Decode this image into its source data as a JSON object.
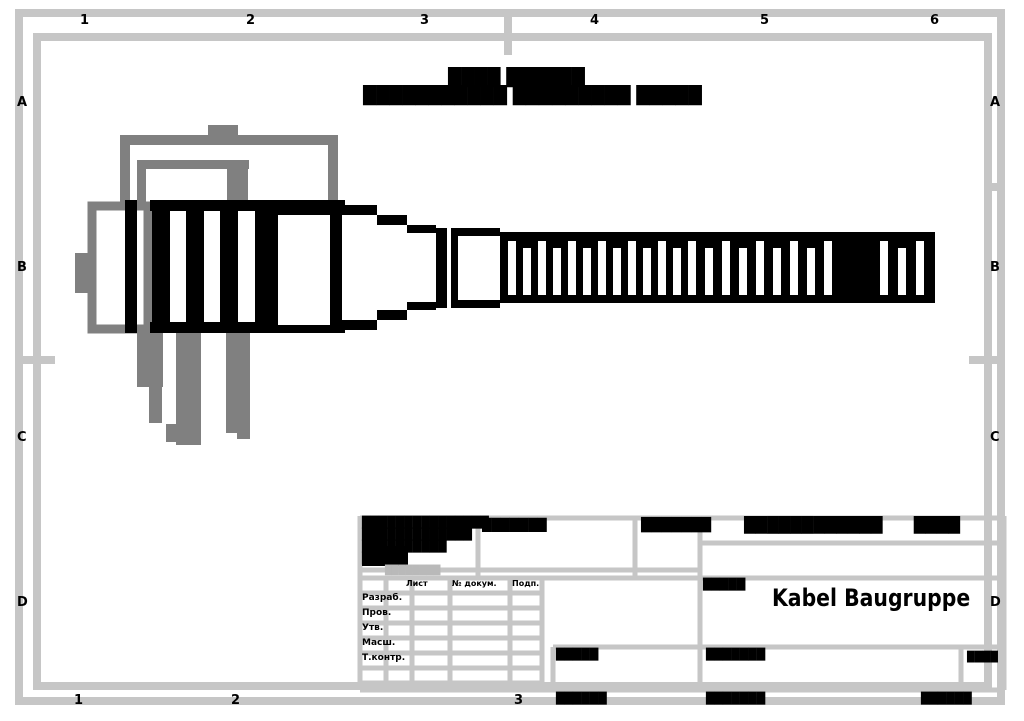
{
  "colors": {
    "line_black": "#000000",
    "layer_gray": "#808080",
    "frame_silver": "#c6c6c6",
    "paper_white": "#ffffff"
  },
  "frame": {
    "zones_top": [
      "1",
      "2",
      "3",
      "4",
      "5",
      "6"
    ],
    "zones_bottom": [
      "1",
      "2",
      "3"
    ],
    "zones_left": [
      "A",
      "B",
      "C",
      "D"
    ],
    "zones_right": [
      "A",
      "B",
      "C",
      "D"
    ]
  },
  "drawing": {
    "note_line1": "████ ██████",
    "note_line2": "███████████ █████████ █████"
  },
  "title_block": {
    "rev_line1": "███████████████",
    "rev_line2": "█████████████",
    "rev_line3": "██████████",
    "rev_line4": "█████",
    "rev_gray": "████████",
    "cell_b_label": "███████",
    "cell_c_label": "███████",
    "designation": "████████████      ████",
    "col_header_1": "Лист",
    "col_header_2": "№ докум.",
    "col_header_3": "Подп.",
    "row_label_1": "Разраб.",
    "row_label_2": "Пров.",
    "row_label_3": "Утв.",
    "row_label_4": "Масш.",
    "row_label_5": "Т.контр.",
    "lit_label": "█████",
    "title": "Kabel Baugruppe",
    "mid_cell_label": "█████",
    "right_cell_label": "███████",
    "sheet_cell_label": "████",
    "footer_label_1": "██████",
    "footer_label_2": "███████",
    "footer_label_3": "██████"
  }
}
